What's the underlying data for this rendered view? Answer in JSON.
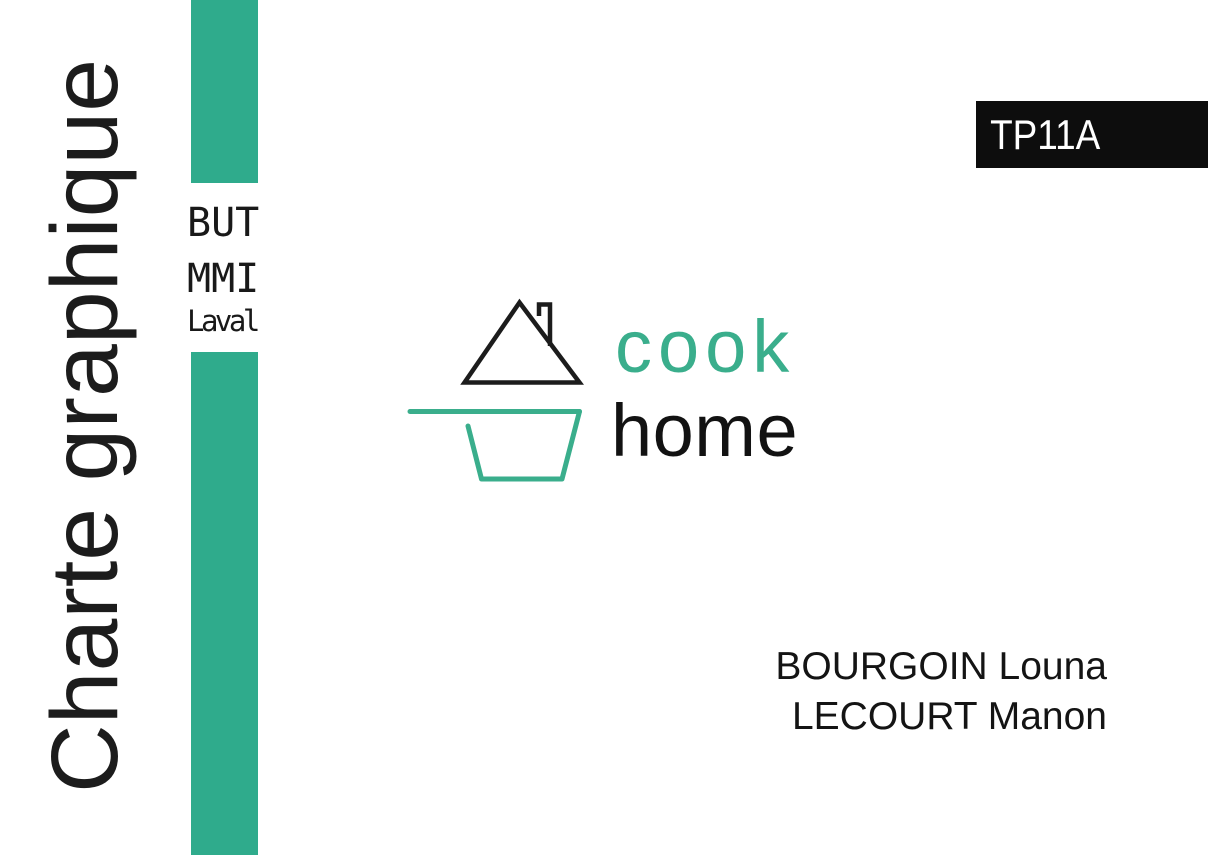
{
  "title": "Charte graphique",
  "program": {
    "line1": "BUT",
    "line2": "MMI",
    "line3": "Laval"
  },
  "badge": {
    "label": "TP11A"
  },
  "logo": {
    "word_top": "cook",
    "word_bottom": "home",
    "icon": "house-roof-and-cooking-pot"
  },
  "authors": {
    "line1": "BOURGOIN Louna",
    "line2": "LECOURT Manon"
  },
  "colors": {
    "accent_bar": "#2fab8c",
    "accent_logo": "#3aae8c",
    "ink": "#1c1c1c",
    "badge_bg": "#0d0d0d",
    "badge_fg": "#ffffff",
    "page_bg": "#ffffff"
  }
}
